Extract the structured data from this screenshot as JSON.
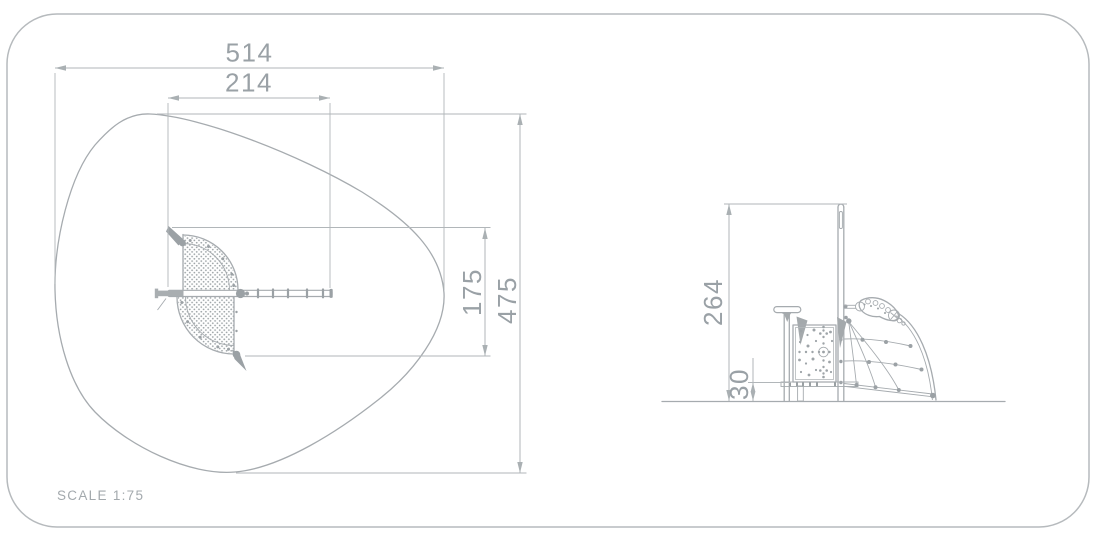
{
  "document": {
    "type": "technical-drawing",
    "footer": {
      "scale_label": "SCALE 1:75"
    },
    "colors": {
      "background": "#ffffff",
      "line": "#a6abaf",
      "dimension_line": "#b1b6b9",
      "dimension_text": "#9aa1a6",
      "sheet_border": "#b6babd"
    },
    "views": {
      "plan": {
        "label": "plan-view",
        "dims": {
          "total_width": "514",
          "platform_width": "214",
          "platform_depth": "175",
          "total_depth": "475"
        }
      },
      "elevation": {
        "label": "side-elevation-view",
        "dims": {
          "overall_height": "264",
          "deck_height": "30"
        }
      }
    }
  }
}
